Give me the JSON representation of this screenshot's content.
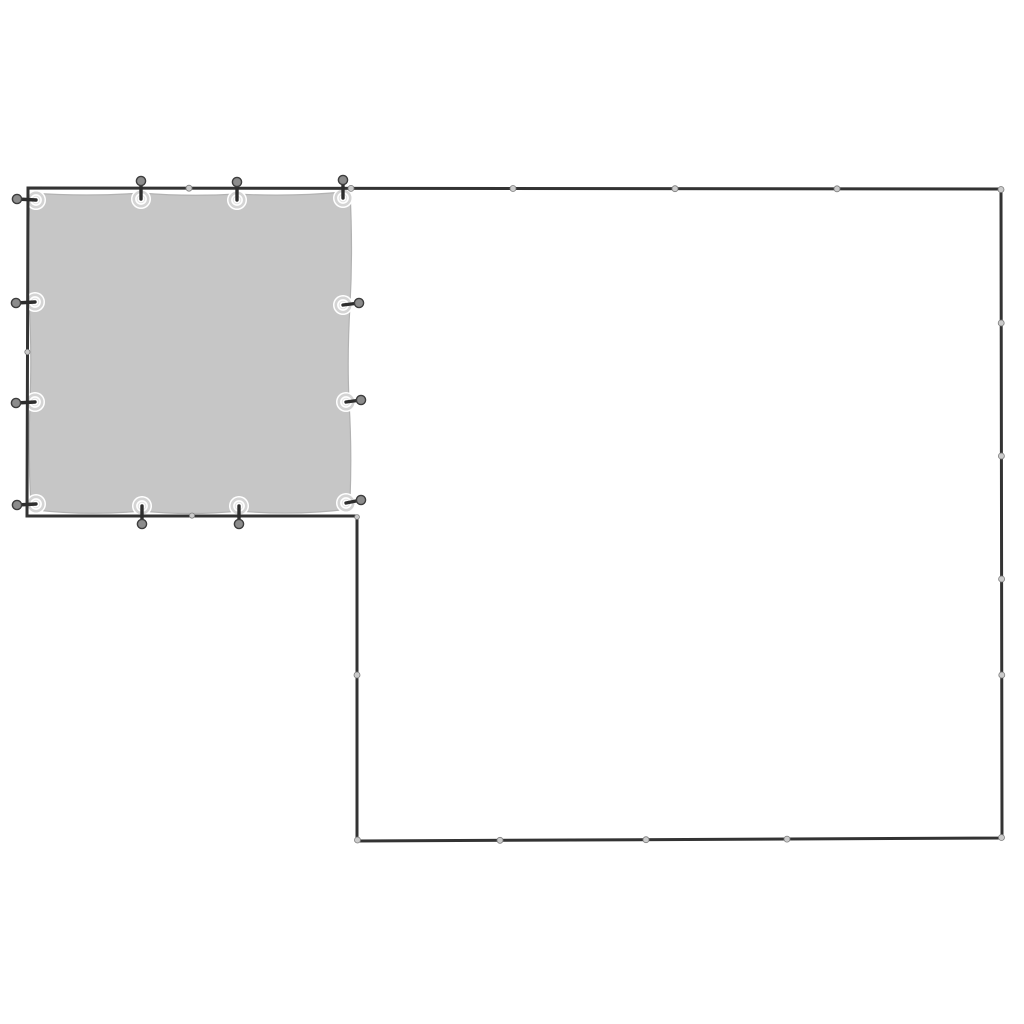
{
  "image": {
    "background": "#ffffff"
  },
  "colors": {
    "tarp_fill": "#c6c6c6",
    "tarp_edge": "#b2b2b2",
    "frame_stroke": "#333333",
    "bead_fill": "#cbcbcb",
    "bead_stroke": "#7d7d7d",
    "grommet_fill": "#ffffff",
    "grommet_ring": "#d4d4d4",
    "grommet_inner_ring": "#e3e3e3",
    "halo": "#ffffff",
    "pin": "#2d2d2d",
    "knob_fill": "#8c8c8c",
    "knob_stroke": "#3d3d3d"
  },
  "scene": {
    "canvas": {
      "width": 1024,
      "height": 1024
    },
    "frame": {
      "path": "M 28 188 L 1001 189 L 1002 838 L 357 841 L 357 516 L 27 516 Z",
      "stroke_width": 3
    },
    "tarp": {
      "path": "M 30 193 Q 88 197 141 193 Q 189 197 237 194 Q 290 197 343 192 L 350 192 Q 353 250 350 305 Q 347 355 349 402 Q 352 450 350 500 L 350 506 L 349 509 Q 295 516 239 511 Q 190 516 142 511 Q 88 516 36 510 L 31 508 Q 28 455 30 402 Q 32 350 29 302 Q 27 248 30 200 Z",
      "edge_width": 1.2
    },
    "joints": [
      {
        "x": 189,
        "y": 188.2,
        "r": 3
      },
      {
        "x": 351,
        "y": 188.4,
        "r": 3
      },
      {
        "x": 513,
        "y": 188.5,
        "r": 3
      },
      {
        "x": 675,
        "y": 188.7,
        "r": 3
      },
      {
        "x": 837,
        "y": 188.8,
        "r": 3
      },
      {
        "x": 1001,
        "y": 189.5,
        "r": 3
      },
      {
        "x": 1001.2,
        "y": 323,
        "r": 3
      },
      {
        "x": 1001.4,
        "y": 456,
        "r": 3
      },
      {
        "x": 1001.6,
        "y": 579,
        "r": 3
      },
      {
        "x": 1001.8,
        "y": 675,
        "r": 3
      },
      {
        "x": 1001.5,
        "y": 837.5,
        "r": 3
      },
      {
        "x": 787,
        "y": 839.1,
        "r": 3
      },
      {
        "x": 646,
        "y": 839.7,
        "r": 3
      },
      {
        "x": 500,
        "y": 840.3,
        "r": 3
      },
      {
        "x": 357.5,
        "y": 840,
        "r": 3
      },
      {
        "x": 357,
        "y": 675,
        "r": 3
      },
      {
        "x": 357,
        "y": 517,
        "r": 2.4
      },
      {
        "x": 192,
        "y": 515.6,
        "r": 2.6
      },
      {
        "x": 27.4,
        "y": 352,
        "r": 2.6
      }
    ],
    "attachments": [
      {
        "side": "left",
        "gx": 36,
        "gy": 200,
        "kx": 17,
        "ky": 199
      },
      {
        "side": "left",
        "gx": 35,
        "gy": 302,
        "kx": 16,
        "ky": 303
      },
      {
        "side": "left",
        "gx": 35,
        "gy": 402,
        "kx": 16,
        "ky": 403
      },
      {
        "side": "left",
        "gx": 36,
        "gy": 504,
        "kx": 17,
        "ky": 505
      },
      {
        "side": "top",
        "gx": 141,
        "gy": 199,
        "kx": 141,
        "ky": 181
      },
      {
        "side": "top",
        "gx": 237,
        "gy": 200,
        "kx": 237,
        "ky": 182
      },
      {
        "side": "top",
        "gx": 343,
        "gy": 198,
        "kx": 343,
        "ky": 180
      },
      {
        "side": "right",
        "gx": 343,
        "gy": 305,
        "kx": 359,
        "ky": 303
      },
      {
        "side": "right",
        "gx": 346,
        "gy": 402,
        "kx": 361,
        "ky": 400
      },
      {
        "side": "right",
        "gx": 346,
        "gy": 503,
        "kx": 361,
        "ky": 500
      },
      {
        "side": "bottom",
        "gx": 142,
        "gy": 506,
        "kx": 142,
        "ky": 524
      },
      {
        "side": "bottom",
        "gx": 239,
        "gy": 506,
        "kx": 239,
        "ky": 524
      }
    ],
    "attachment_geometry": {
      "halo_radius": 10,
      "grommet_radius": 7.2,
      "grommet_ring_width": 2.6,
      "grommet_inner_radius": 3.8,
      "pin_width": 3.4,
      "knob_radius": 4.6,
      "knob_stroke_width": 1.4
    }
  }
}
